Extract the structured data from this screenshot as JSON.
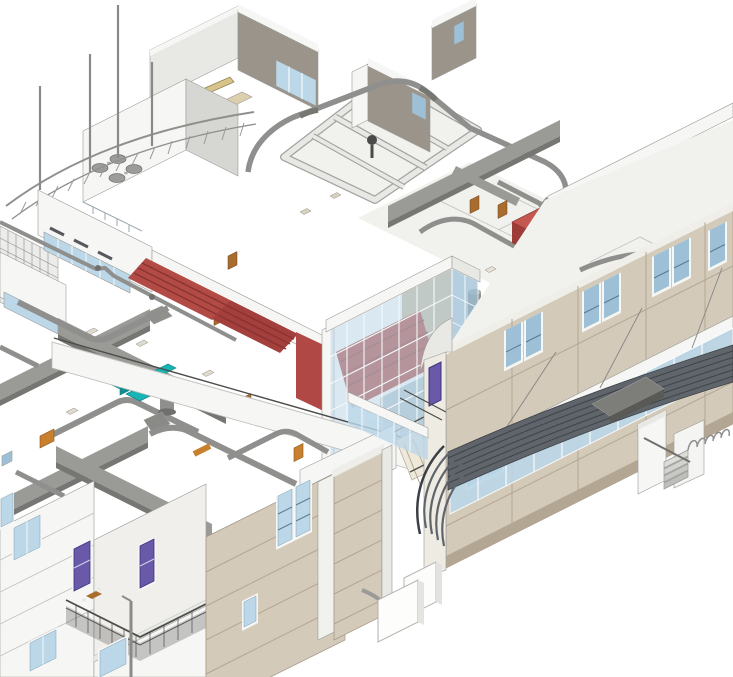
{
  "canvas": {
    "width": 733,
    "height": 677
  },
  "colors": {
    "background": "#ffffff",
    "wall_white": "#f6f6f4",
    "wall_shade": "#e8e8e5",
    "wall_dark": "#d6d6d3",
    "floor": "#f1f1ee",
    "floor_tan": "#ddcfae",
    "brown_wall": "#9a948a",
    "line": "#8f8f8c",
    "duct": "#9a9a97",
    "duct_pipe": "#8f8f8d",
    "duct_dark": "#767673",
    "beige": "#d4cab9",
    "beige_dark": "#b3a793",
    "beige_deep": "#a79a85",
    "glass": "#bcd7e8",
    "glass_dark": "#9dc0d6",
    "glass_pale": "#dcebf4",
    "mullion": "#f4f8fa",
    "red": "#b24a45",
    "red_dark": "#8c3331",
    "teal": "#18b4b4",
    "teal_dark": "#0e8e90",
    "purple": "#6a58a8",
    "door": "#a86c2e",
    "orange": "#c8802f",
    "canopy": "#60656c",
    "canopy_dark": "#3e4349",
    "rail": "#4c4c4a",
    "steel": "#8a8a88"
  }
}
